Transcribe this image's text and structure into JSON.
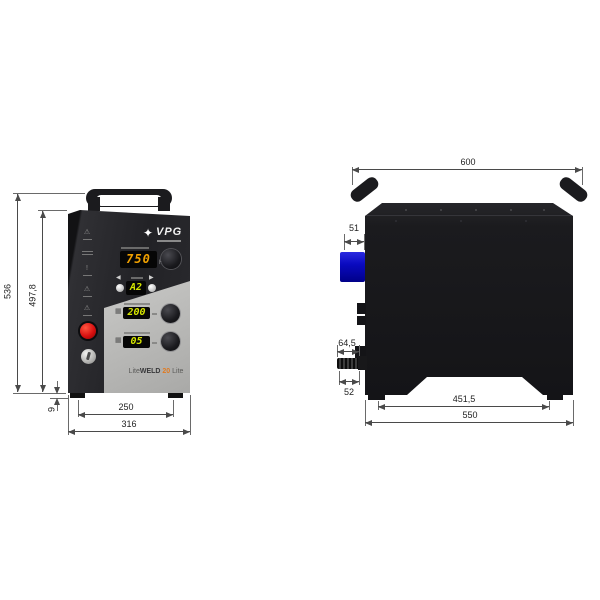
{
  "front": {
    "logo": {
      "mark": "✦",
      "name": "VPG"
    },
    "display_freq": {
      "value": "750",
      "unit": "Hz"
    },
    "nav": {
      "left": "◀",
      "right": "▶"
    },
    "display_program": {
      "value": "A2"
    },
    "display_power": {
      "value": "200"
    },
    "display_time": {
      "value": "05"
    },
    "warning_glyphs": [
      "⚠",
      "!",
      "⚠",
      "⚠"
    ],
    "model": {
      "p1": "Lite",
      "p2": "WELD",
      "p3": "20",
      "p4": "Lite"
    },
    "dims": {
      "total_height": "536",
      "body_height": "497,8",
      "foot_height": "9",
      "foot_span": "250",
      "total_width": "316"
    }
  },
  "side": {
    "dims": {
      "total_width": "600",
      "connector_depth": "51",
      "fitting_depth": "64,5",
      "fitting_gap": "52",
      "foot_span": "451,5",
      "body_depth": "550"
    }
  },
  "colors": {
    "accent_orange": "#e07a20",
    "digit_amber": "#f0a000",
    "digit_green": "#d6e600",
    "connector_blue": "#0a0ac0",
    "estop_red": "#d81010"
  }
}
